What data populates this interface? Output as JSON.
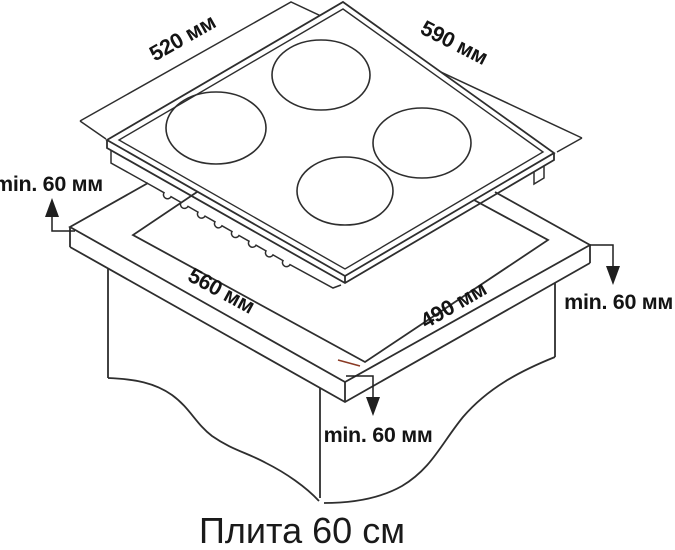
{
  "title": "Плита 60 см",
  "diagram": {
    "dimensions": {
      "hob_width": "520 мм",
      "hob_depth": "590 мм",
      "cutout_width": "560 мм",
      "cutout_depth": "490 мм"
    },
    "clearances": {
      "left": "min. 60 мм",
      "right": "min. 60 мм",
      "front": "min. 60 мм"
    },
    "colors": {
      "line": "#2e2e2e",
      "text": "#141414",
      "artifact_red": "#8a3a24"
    },
    "parts": {
      "hob": "варочная панель с 4 конфорками",
      "countertop": "столешница с вырезом",
      "burner_count": 4
    }
  }
}
